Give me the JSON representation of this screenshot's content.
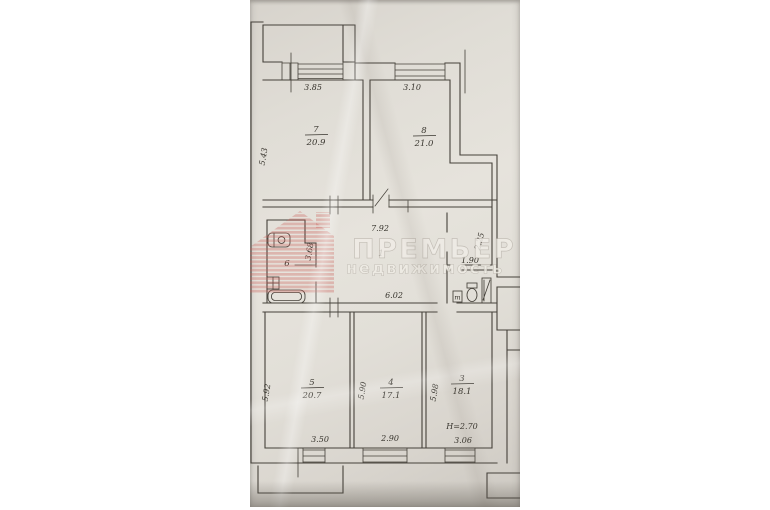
{
  "watermark": {
    "title": "ПРЕМЬЕР",
    "subtitle": "недвижимость",
    "logo": "striped-house-icon",
    "logo_color": "#c95f58",
    "text_color": "#efece5"
  },
  "rooms": {
    "r7": {
      "num": "7",
      "area": "20.9",
      "width": "3.85",
      "depth": "5.43"
    },
    "r8": {
      "num": "8",
      "area": "21.0",
      "width": "3.10"
    },
    "r6": {
      "num": "6",
      "depth": "3.68"
    },
    "r1": {
      "num": "1",
      "top_width": "7.92",
      "bottom_width": "6.02"
    },
    "wc": {
      "width": "1.90",
      "depth": "2.25",
      "fixture_label": "т"
    },
    "r5": {
      "num": "5",
      "area": "20.7",
      "width": "3.50",
      "depth": "5.92"
    },
    "r4": {
      "num": "4",
      "area": "17.1",
      "width": "2.90",
      "depth": "5.90"
    },
    "r3": {
      "num": "3",
      "area": "18.1",
      "width": "3.06",
      "depth": "5.98",
      "ceiling_height": "Н=2.70"
    }
  }
}
